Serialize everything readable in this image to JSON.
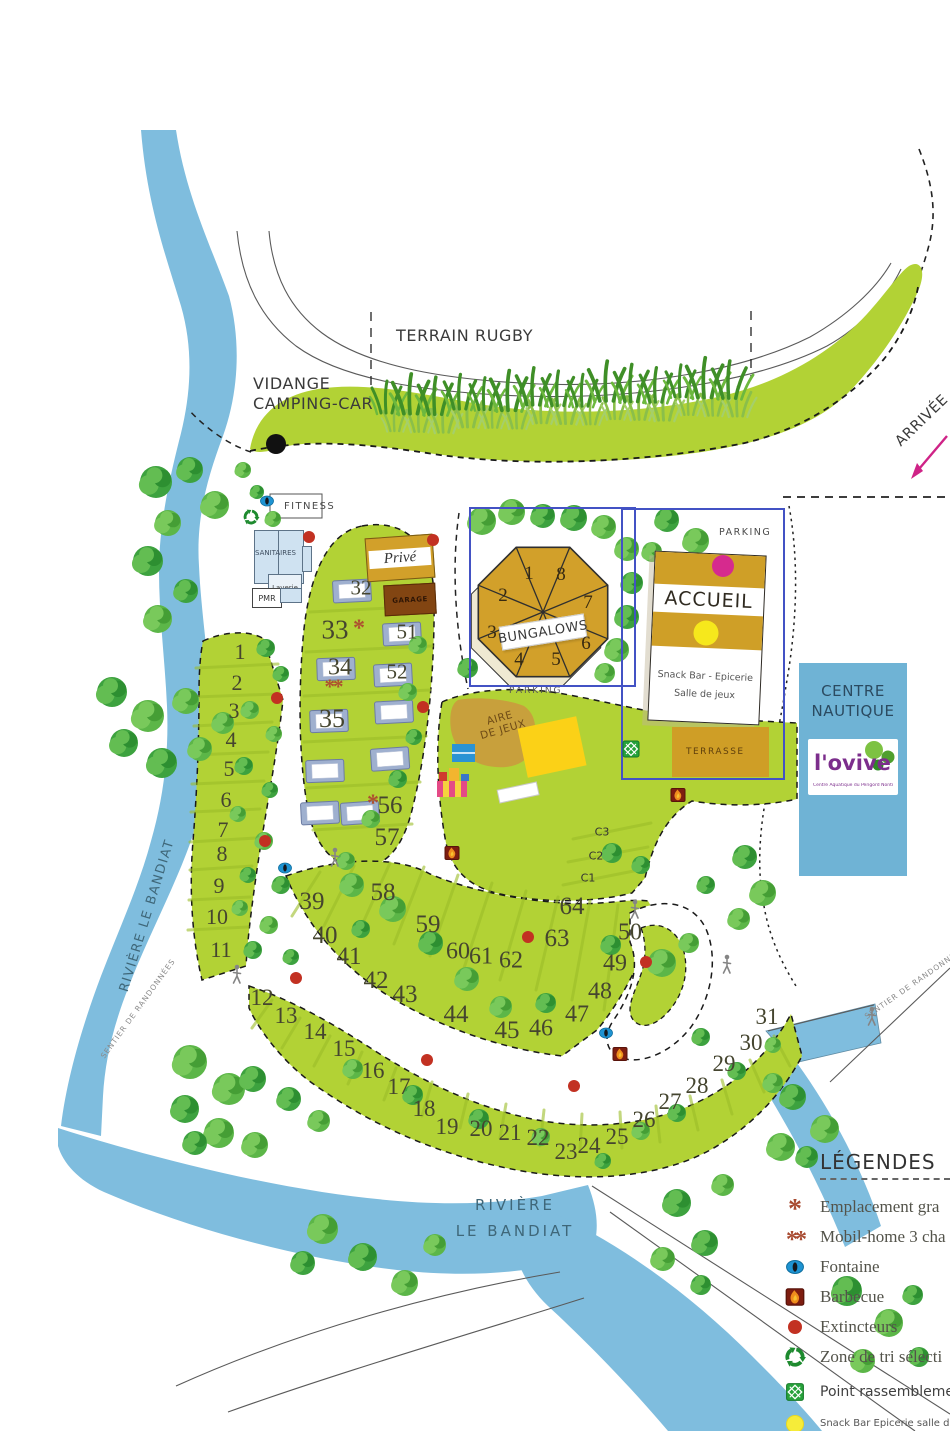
{
  "map": {
    "labels": {
      "terrain_rugby": "Terrain Rugby",
      "vidange_1": "Vidange",
      "vidange_2": "camping-car",
      "arrivee": "Arrivée",
      "fitness": "FITNESS",
      "sanitaires": "SANITAIRES",
      "laverie": "Laverie",
      "pmr": "PMR",
      "prive": "Privé",
      "garage": "GARAGE",
      "bungalows": "Bungalows",
      "parking_bungalows": "PARKING",
      "parking_accueil": "PARKING",
      "accueil": "Accueil",
      "accueil_line2": "Snack Bar - Epicerie",
      "accueil_line3": "Salle de jeux",
      "terrasse": "TERRASSE",
      "centre_nautique_1": "Centre",
      "centre_nautique_2": "Nautique",
      "ovive": "l'ovive",
      "ovive_sub": "Centre Aquatique du Périgord Nontronnais",
      "aire_jeux_1": "Aire",
      "aire_jeux_2": "de jeux",
      "riviere_left": "Rivière le Bandiat",
      "riviere_bottom_1": "Rivière",
      "riviere_bottom_2": "le Bandiat",
      "sentier_left": "Sentier de randonnées",
      "sentier_right": "Sentier de randonnées"
    },
    "bungalow_units": [
      {
        "label": "1",
        "x": 529,
        "y": 574
      },
      {
        "label": "2",
        "x": 503,
        "y": 596
      },
      {
        "label": "3",
        "x": 492,
        "y": 633
      },
      {
        "label": "4",
        "x": 519,
        "y": 660
      },
      {
        "label": "5",
        "x": 556,
        "y": 660
      },
      {
        "label": "6",
        "x": 586,
        "y": 644
      },
      {
        "label": "7",
        "x": 588,
        "y": 603
      },
      {
        "label": "8",
        "x": 561,
        "y": 575
      }
    ],
    "zone_labels": [
      {
        "label": "C3",
        "x": 602,
        "y": 832
      },
      {
        "label": "C2",
        "x": 596,
        "y": 856
      },
      {
        "label": "C1",
        "x": 588,
        "y": 878
      }
    ],
    "pitches": [
      {
        "label": "1",
        "x": 240,
        "y": 652,
        "fs": 22
      },
      {
        "label": "2",
        "x": 237,
        "y": 683,
        "fs": 22
      },
      {
        "label": "3",
        "x": 234,
        "y": 711,
        "fs": 22
      },
      {
        "label": "4",
        "x": 231,
        "y": 740,
        "fs": 22
      },
      {
        "label": "5",
        "x": 229,
        "y": 769,
        "fs": 22
      },
      {
        "label": "6",
        "x": 226,
        "y": 800,
        "fs": 22
      },
      {
        "label": "7",
        "x": 223,
        "y": 830,
        "fs": 22
      },
      {
        "label": "8",
        "x": 222,
        "y": 854,
        "fs": 22
      },
      {
        "label": "9",
        "x": 219,
        "y": 886,
        "fs": 22
      },
      {
        "label": "10",
        "x": 217,
        "y": 917,
        "fs": 22
      },
      {
        "label": "11",
        "x": 221,
        "y": 950,
        "fs": 22
      },
      {
        "label": "12",
        "x": 262,
        "y": 998
      },
      {
        "label": "13",
        "x": 286,
        "y": 1016
      },
      {
        "label": "14",
        "x": 315,
        "y": 1032
      },
      {
        "label": "15",
        "x": 344,
        "y": 1049
      },
      {
        "label": "16",
        "x": 373,
        "y": 1071
      },
      {
        "label": "17",
        "x": 399,
        "y": 1087
      },
      {
        "label": "18",
        "x": 424,
        "y": 1109
      },
      {
        "label": "19",
        "x": 447,
        "y": 1127
      },
      {
        "label": "20",
        "x": 481,
        "y": 1129
      },
      {
        "label": "21",
        "x": 510,
        "y": 1133
      },
      {
        "label": "22",
        "x": 538,
        "y": 1138
      },
      {
        "label": "23",
        "x": 566,
        "y": 1152
      },
      {
        "label": "24",
        "x": 589,
        "y": 1146
      },
      {
        "label": "25",
        "x": 617,
        "y": 1137
      },
      {
        "label": "26",
        "x": 644,
        "y": 1120
      },
      {
        "label": "27",
        "x": 670,
        "y": 1102
      },
      {
        "label": "28",
        "x": 697,
        "y": 1086
      },
      {
        "label": "29",
        "x": 724,
        "y": 1064
      },
      {
        "label": "30",
        "x": 751,
        "y": 1043
      },
      {
        "label": "31",
        "x": 767,
        "y": 1017
      },
      {
        "label": "32",
        "x": 361,
        "y": 588,
        "fs": 21
      },
      {
        "label": "33",
        "x": 335,
        "y": 630,
        "fs": 27
      },
      {
        "label": "34",
        "x": 340,
        "y": 668,
        "fs": 24
      },
      {
        "label": "35",
        "x": 332,
        "y": 719,
        "fs": 26
      },
      {
        "label": "51",
        "x": 407,
        "y": 632,
        "fs": 21
      },
      {
        "label": "52",
        "x": 397,
        "y": 672,
        "fs": 21
      },
      {
        "label": "56",
        "x": 390,
        "y": 806,
        "fs": 25
      },
      {
        "label": "57",
        "x": 387,
        "y": 838,
        "fs": 25
      },
      {
        "label": "58",
        "x": 383,
        "y": 893,
        "fs": 25
      },
      {
        "label": "59",
        "x": 428,
        "y": 925,
        "fs": 25
      },
      {
        "label": "60",
        "x": 458,
        "y": 952,
        "fs": 24
      },
      {
        "label": "61",
        "x": 481,
        "y": 957,
        "fs": 24
      },
      {
        "label": "62",
        "x": 511,
        "y": 961,
        "fs": 24
      },
      {
        "label": "63",
        "x": 557,
        "y": 939,
        "fs": 25
      },
      {
        "label": "64",
        "x": 572,
        "y": 907,
        "fs": 25
      },
      {
        "label": "39",
        "x": 312,
        "y": 902,
        "fs": 25
      },
      {
        "label": "40",
        "x": 325,
        "y": 936,
        "fs": 25
      },
      {
        "label": "41",
        "x": 349,
        "y": 957,
        "fs": 25
      },
      {
        "label": "42",
        "x": 376,
        "y": 981,
        "fs": 25
      },
      {
        "label": "43",
        "x": 405,
        "y": 995,
        "fs": 25
      },
      {
        "label": "44",
        "x": 456,
        "y": 1015,
        "fs": 25
      },
      {
        "label": "45",
        "x": 507,
        "y": 1031,
        "fs": 25
      },
      {
        "label": "46",
        "x": 541,
        "y": 1029,
        "fs": 24
      },
      {
        "label": "47",
        "x": 577,
        "y": 1015,
        "fs": 24
      },
      {
        "label": "48",
        "x": 600,
        "y": 992,
        "fs": 24
      },
      {
        "label": "49",
        "x": 615,
        "y": 964,
        "fs": 24
      },
      {
        "label": "50",
        "x": 630,
        "y": 933,
        "fs": 24
      }
    ],
    "special_markers": [
      {
        "symbol": "*",
        "x": 359,
        "y": 629,
        "fs": 24
      },
      {
        "symbol": "**",
        "x": 333,
        "y": 687,
        "fs": 21
      },
      {
        "symbol": "*",
        "x": 373,
        "y": 804,
        "fs": 24
      }
    ],
    "markers": {
      "fountains": [
        [
          267,
          501
        ],
        [
          285,
          868
        ],
        [
          606,
          1033
        ]
      ],
      "extinguishers": [
        [
          309,
          537
        ],
        [
          433,
          540
        ],
        [
          277,
          698
        ],
        [
          423,
          707
        ],
        [
          265,
          841
        ],
        [
          296,
          978
        ],
        [
          528,
          937
        ],
        [
          646,
          962
        ],
        [
          427,
          1060
        ],
        [
          574,
          1086
        ]
      ],
      "barbecues": [
        [
          678,
          795
        ],
        [
          452,
          853
        ],
        [
          620,
          1054
        ]
      ],
      "assembly_points": [
        [
          631,
          749
        ]
      ],
      "walkers": [
        [
          237,
          974
        ],
        [
          335,
          857
        ],
        [
          635,
          909
        ],
        [
          727,
          964
        ],
        [
          872,
          1016
        ]
      ],
      "vidange_point": [
        276,
        444
      ],
      "reception_point": [
        723,
        566
      ],
      "snack_point": [
        706,
        633
      ]
    }
  },
  "legend": {
    "title": "Légendes",
    "items": [
      {
        "icon": "asterisk",
        "label": "Emplacement gra"
      },
      {
        "icon": "double-asterisk",
        "label": "Mobil-home 3 cha"
      },
      {
        "icon": "fountain",
        "label": "Fontaine"
      },
      {
        "icon": "barbecue",
        "label": "Barbecue"
      },
      {
        "icon": "extinguisher",
        "label": "Extincteurs"
      },
      {
        "icon": "recycle",
        "label": "Zone de tri sélecti"
      },
      {
        "icon": "assembly-point",
        "label": "Point rassemblemen"
      },
      {
        "icon": "snack",
        "label": "Snack Bar Epicerie salle de jeu"
      }
    ]
  },
  "colors": {
    "grass": "#b2d235",
    "river": "#7fbdde",
    "gold": "#cf9f27",
    "blue_frame": "#4352c4",
    "magenta": "#d62a8e",
    "yellow": "#f6e81c",
    "red_dot": "#c23122",
    "recycle_green": "#1d8a2e"
  }
}
